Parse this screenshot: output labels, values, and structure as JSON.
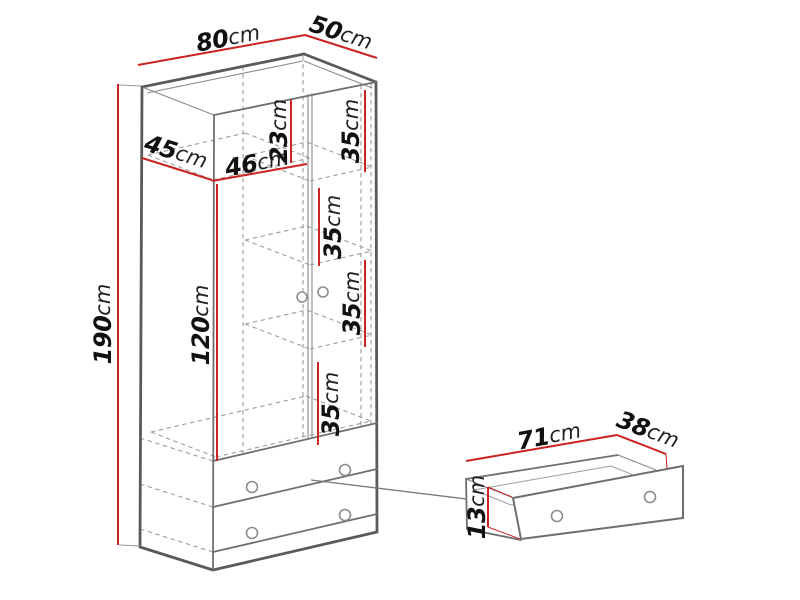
{
  "page": {
    "background": "#ffffff"
  },
  "diagram": {
    "kind": "furniture dimension diagram",
    "subject": "two-door wardrobe with two bottom drawers, plus detached drawer detail view",
    "unit": "cm",
    "colors": {
      "dimension_line": "#cc2222",
      "outline": "#5a5a5a",
      "outline_secondary": "#6f6f6f",
      "hidden_line": "#9d9d9d",
      "text": "#111111",
      "background": "#ffffff"
    },
    "wardrobe": {
      "overall": {
        "width": "80cm",
        "depth": "50cm",
        "height": "190cm"
      },
      "interior": {
        "top_shelf_depth": "45cm",
        "left_compartment_width": "46cm",
        "top_compartment_height": "23cm",
        "hanging_space_height": "120cm",
        "shelf_spacing": [
          "35cm",
          "35cm",
          "35cm",
          "35cm"
        ],
        "shelf_depth": "45cm"
      },
      "doors": 2,
      "drawers": 2
    },
    "drawer_detail": {
      "width": "71cm",
      "depth": "38cm",
      "front_height": "13cm"
    },
    "dimensions": [
      {
        "id": "width-80",
        "value": "80",
        "unit": "cm",
        "line": [
          138,
          65,
          305,
          35
        ],
        "label": [
          228,
          38
        ],
        "rot": -10.5,
        "ticks": []
      },
      {
        "id": "depth-50",
        "value": "50",
        "unit": "cm",
        "line": [
          305,
          35,
          377,
          58
        ],
        "label": [
          341,
          33
        ],
        "rot": 18,
        "ticks": []
      },
      {
        "id": "height-190",
        "value": "190",
        "unit": "cm",
        "line": [
          118,
          84,
          118,
          545
        ],
        "label": [
          103,
          324
        ],
        "rot": -90,
        "ticks": [
          [
            119,
            85,
            141,
            86,
            "gray"
          ],
          [
            119,
            545,
            140,
            546,
            "gray"
          ]
        ]
      },
      {
        "id": "shelf-depth-45",
        "value": "45",
        "unit": "cm",
        "line": [
          142,
          158,
          212,
          180
        ],
        "label": [
          176,
          152
        ],
        "rot": 17.5,
        "ticks": []
      },
      {
        "id": "compartment-46",
        "value": "46",
        "unit": "cm",
        "line": [
          212,
          181,
          307,
          164
        ],
        "label": [
          257,
          163
        ],
        "rot": -10,
        "ticks": []
      },
      {
        "id": "top-gap-23",
        "value": "23",
        "unit": "cm",
        "line": [
          291,
          100,
          291,
          163
        ],
        "label": [
          279,
          131
        ],
        "rot": -90,
        "ticks": []
      },
      {
        "id": "shelf-35-a",
        "value": "35",
        "unit": "cm",
        "line": [
          365,
          90,
          365,
          172
        ],
        "label": [
          351,
          131
        ],
        "rot": -90,
        "ticks": []
      },
      {
        "id": "shelf-35-b",
        "value": "35",
        "unit": "cm",
        "line": [
          319,
          188,
          319,
          266
        ],
        "label": [
          333,
          227
        ],
        "rot": -90,
        "ticks": []
      },
      {
        "id": "shelf-35-c",
        "value": "35",
        "unit": "cm",
        "line": [
          365,
          260,
          365,
          347
        ],
        "label": [
          352,
          303
        ],
        "rot": -90,
        "ticks": []
      },
      {
        "id": "shelf-35-d",
        "value": "35",
        "unit": "cm",
        "line": [
          318,
          362,
          318,
          445
        ],
        "label": [
          331,
          404
        ],
        "rot": -90,
        "ticks": []
      },
      {
        "id": "hanging-120",
        "value": "120",
        "unit": "cm",
        "line": [
          217,
          184,
          217,
          461
        ],
        "label": [
          201,
          325
        ],
        "rot": -90,
        "ticks": []
      },
      {
        "id": "drawer-width-71",
        "value": "71",
        "unit": "cm",
        "line": [
          466,
          461,
          617,
          435
        ],
        "label": [
          549,
          436
        ],
        "rot": -10.5,
        "ticks": []
      },
      {
        "id": "drawer-depth-38",
        "value": "38",
        "unit": "cm",
        "line": [
          617,
          435,
          666,
          454
        ],
        "label": [
          648,
          430
        ],
        "rot": 21,
        "ticks": [
          [
            666,
            454,
            667,
            469,
            "red"
          ]
        ]
      },
      {
        "id": "drawer-height-13",
        "value": "13",
        "unit": "cm",
        "line": [
          488,
          487,
          488,
          527
        ],
        "label": [
          477,
          507
        ],
        "rot": -90,
        "ticks": [
          [
            488,
            487,
            512,
            497,
            "red"
          ],
          [
            488,
            527,
            520,
            539,
            "red"
          ]
        ]
      }
    ],
    "connector": {
      "from_part": "wardrobe-drawer-front",
      "to_part": "drawer-detail",
      "line": [
        311,
        480,
        581,
        513
      ]
    }
  }
}
